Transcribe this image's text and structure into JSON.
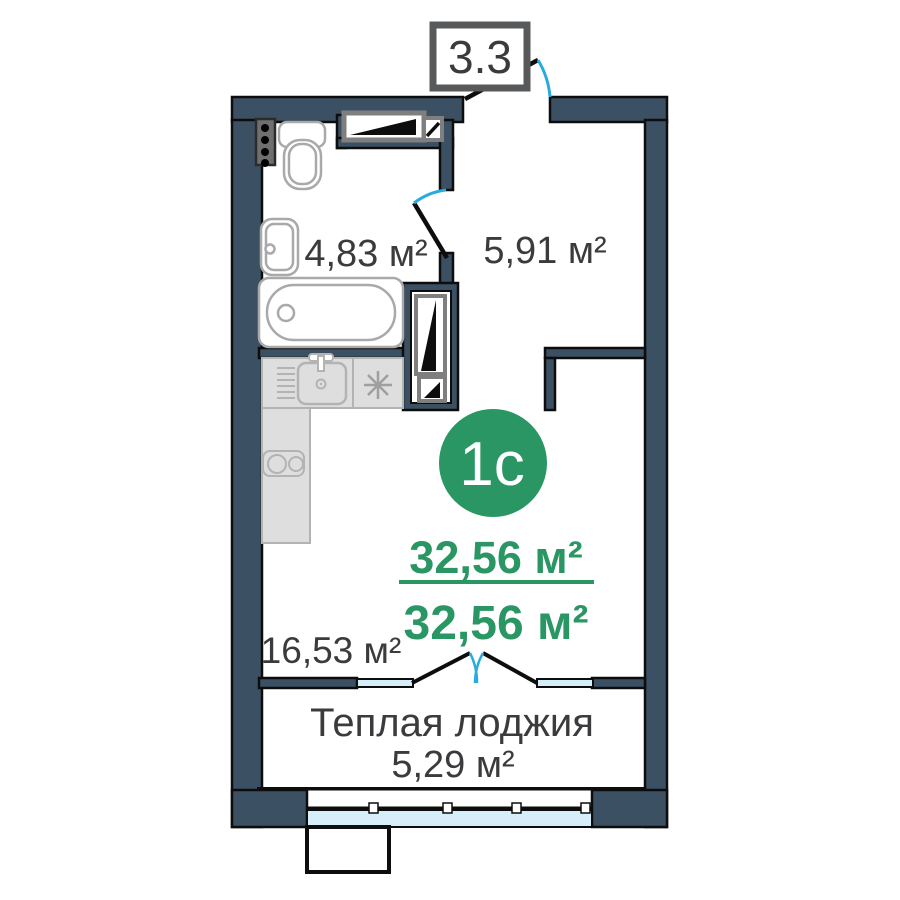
{
  "floor_plan": {
    "unit_label": "3.3",
    "type_badge": "1с",
    "summary": {
      "total_area": "32,56 м²",
      "living_area": "32,56 м²"
    },
    "rooms": [
      {
        "id": "bathroom",
        "area": "4,83 м²"
      },
      {
        "id": "hallway",
        "area": "5,91 м²"
      },
      {
        "id": "living-room",
        "area": "16,53 м²"
      },
      {
        "id": "warm-loggia",
        "title": "Теплая лоджия",
        "area": "5,29 м²"
      }
    ],
    "colors": {
      "wall": "#3c5064",
      "outline": "#0d0d0d",
      "window_glass": "#d6edfa",
      "door_swing_arc": "#29abe2",
      "accent_green": "#2a9663",
      "text_dark": "#3b3b3d",
      "label_box_border": "#58595b",
      "counter_fill": "#dedede",
      "counter_stroke": "#b3b3b3",
      "fixture_stroke": "#a9a9a9",
      "vent_border": "#7f7f7f",
      "riser_fill": "#6f6f6f"
    }
  }
}
